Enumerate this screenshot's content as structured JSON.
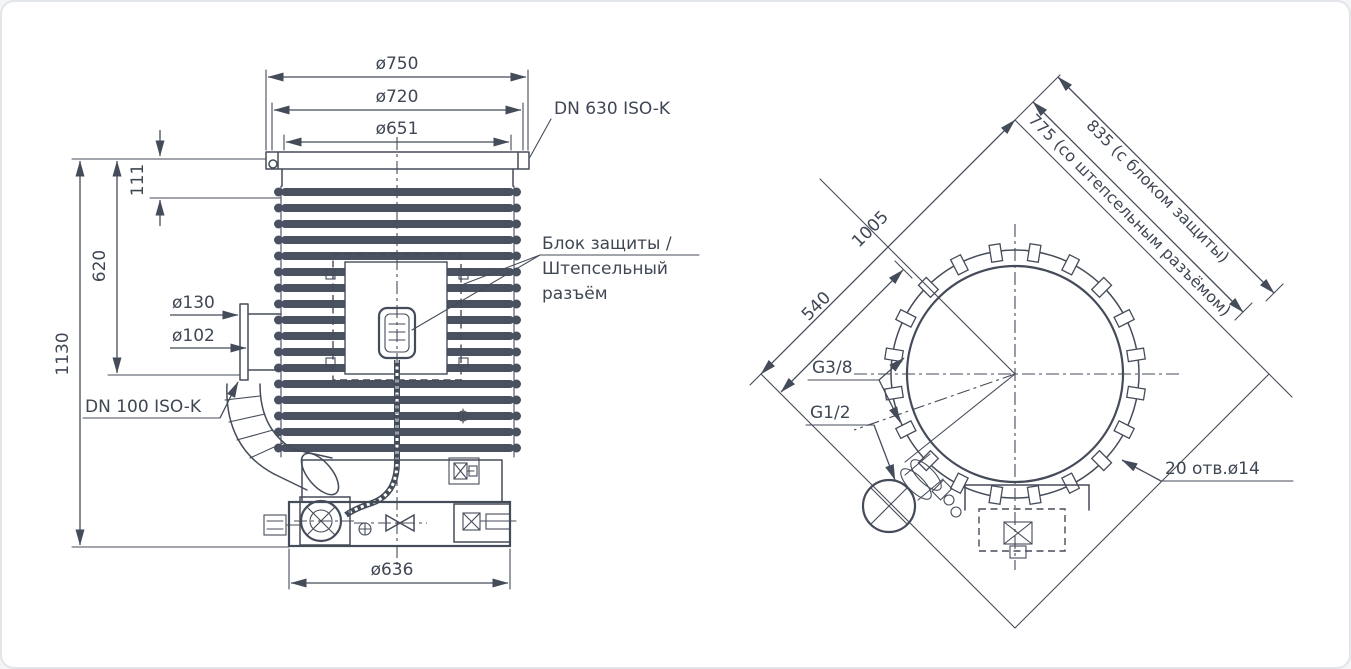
{
  "front": {
    "dia750": "ø750",
    "dia720": "ø720",
    "dia651": "ø651",
    "flange_label": "DN 630 ISO-K",
    "dim111": "111",
    "dim620": "620",
    "dim1130": "1130",
    "dia130": "ø130",
    "dia102": "ø102",
    "port_label": "DN 100 ISO-K",
    "dia636": "ø636",
    "callout_line1": "Блок защиты /",
    "callout_line2": "Штепсельный",
    "callout_line3": "разъём"
  },
  "top": {
    "dim1005": "1005",
    "dim540": "540",
    "dim775": "775 (со штепсельным разъёмом)",
    "dim835": "835 (с блоком защиты)",
    "holes_label": "20 отв.ø14",
    "g38": "G3/8",
    "g12": "G1/2"
  },
  "colors": {
    "line": "#454c59",
    "text": "#3f4754",
    "background": "#ffffff",
    "border": "#e2e5e9"
  }
}
